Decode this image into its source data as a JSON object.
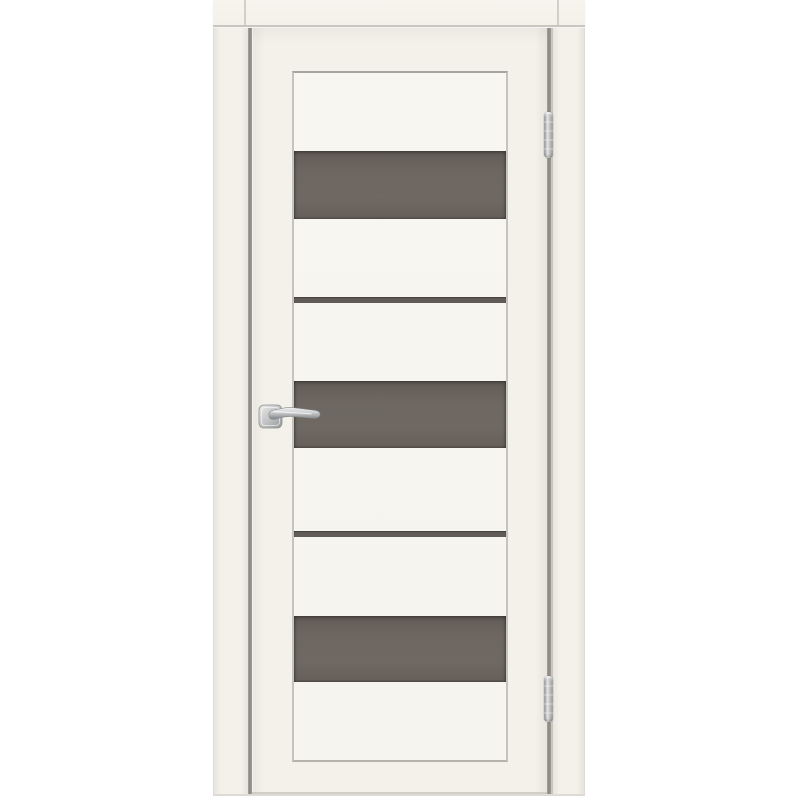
{
  "image": {
    "kind": "product-photo",
    "subject": "Interior door with frame: cream (off-white) finish, glazed leaf with three wide dark bronze-grey glass inserts and two narrow glass strips, chrome lever handle on square rosette at left, two chrome barrel hinges at right",
    "background_color": "#ffffff"
  },
  "door": {
    "finish": "cream / off-white",
    "glass_color_name": "dark bronze-grey",
    "wide_glass_inserts": 3,
    "narrow_glass_strips": 2,
    "hinge_count": 2,
    "hinge_side": "right",
    "hinge_finish": "chrome",
    "handle_side": "left",
    "handle_type": "lever on square rosette",
    "handle_finish": "polished chrome",
    "frame": "visible casing on left, right and top"
  },
  "colors": {
    "bg": "#ffffff",
    "cream": "#f4f1ea",
    "cream-light": "#f7f4ee",
    "panel": "#f8f6f1",
    "line": "#c9c6bf",
    "line-soft": "#dedbd4",
    "line-strong": "#a8a5a0",
    "gap": "#8a8680",
    "glass": "#6e6761",
    "glass-dark": "#625c56",
    "chrome-hi": "#e4e4e4",
    "chrome-mid": "#b9babb",
    "chrome-lo": "#85888a"
  }
}
